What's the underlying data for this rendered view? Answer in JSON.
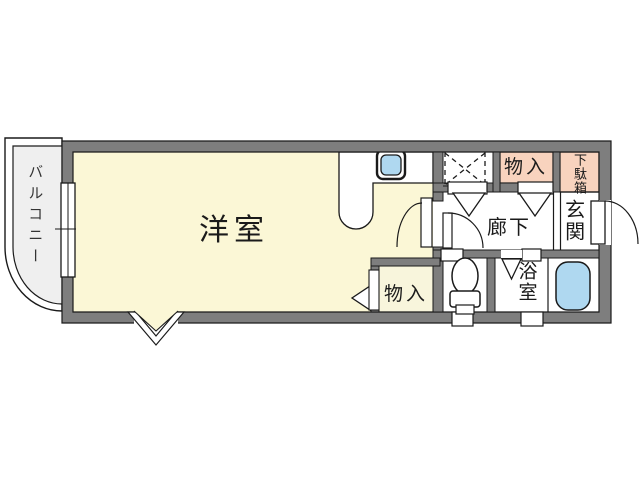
{
  "floor_plan": {
    "labels": {
      "balcony": "バルコニー",
      "main_room": "洋室",
      "storage_upper": "物入",
      "shoe_cabinet": "下駄箱",
      "entrance": "玄関",
      "hallway": "廊下",
      "bathroom": "浴室",
      "storage_lower": "物入"
    },
    "colors": {
      "wall": "#7e7e7e",
      "room_yellow": "#FBF7D6",
      "closet_cream": "#F8F5DC",
      "salmon": "#F8D3BE",
      "water_blue": "#AFD8F0",
      "balcony_gray": "#EFEFEF",
      "line": "#1a1a1a",
      "background": "#ffffff"
    }
  }
}
